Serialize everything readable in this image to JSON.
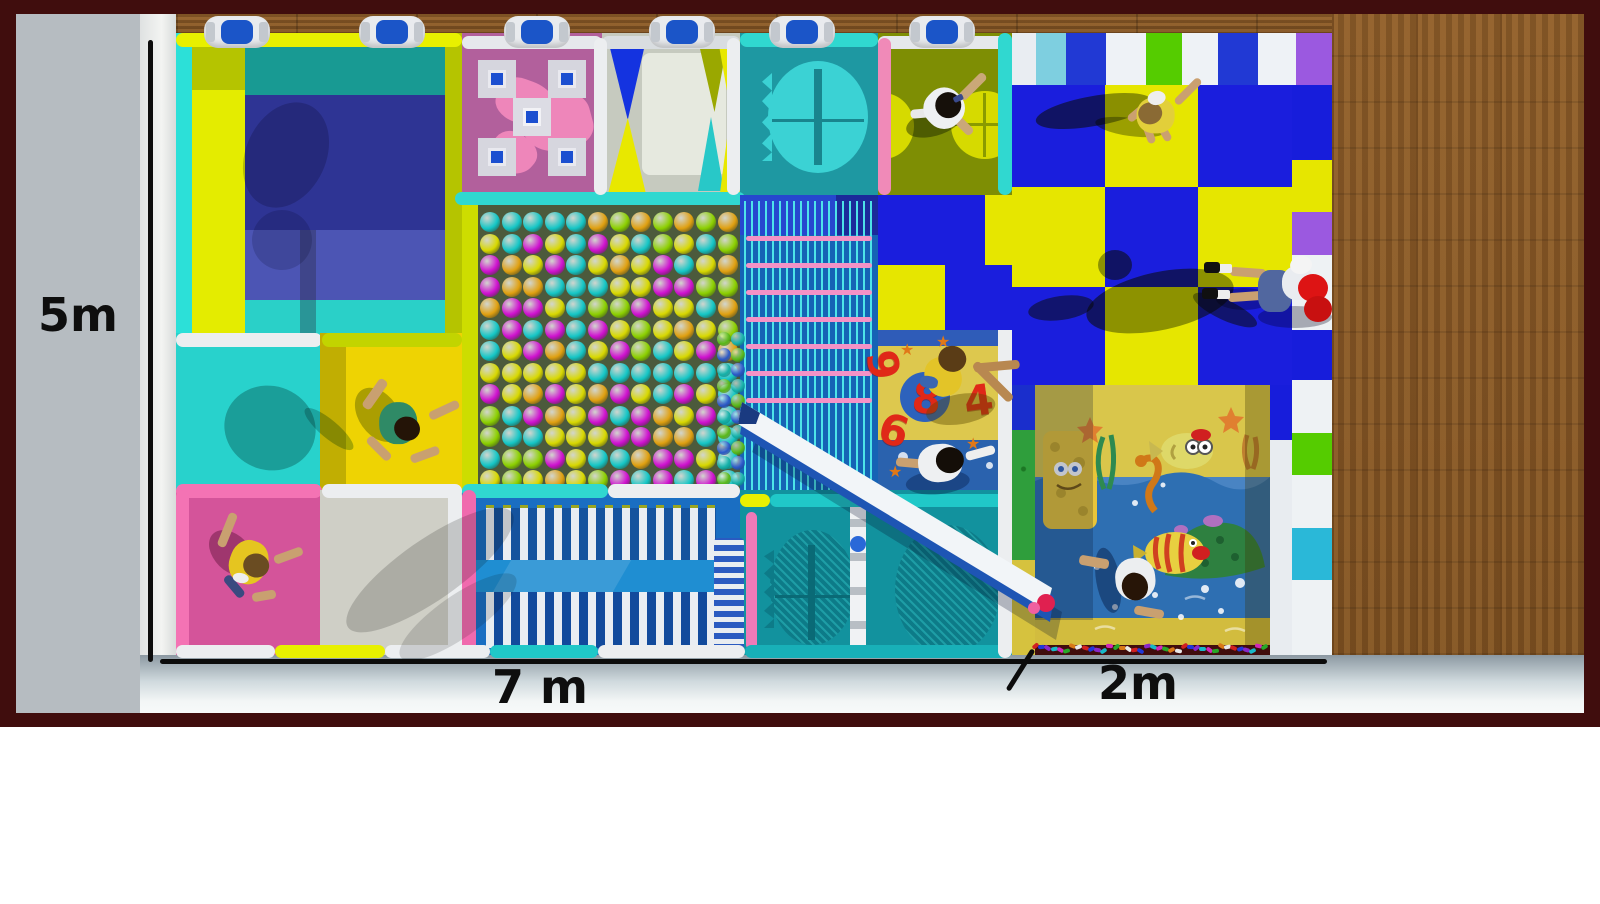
{
  "labels": {
    "height": "5m",
    "width": "7 m",
    "extension": "2m"
  },
  "colors": {
    "frame": "#400d0d",
    "wall": "#b6bcc1",
    "wall_edge": "#f3f4f2",
    "wood": "#8a5a28",
    "floor_top": "#8c99a2",
    "floor_bottom": "#f7f9f9",
    "checker_blue": "#1a1edd",
    "checker_yellow": "#e6e600",
    "ballpit_bg": "#4c5a3c",
    "rope_blue": "#1563b5",
    "rope_pink": "#f492c6",
    "teal": "#12929e",
    "pink_mat": "#d4549a",
    "slide_white": "#f2f5f8",
    "slide_blue": "#1e55b4"
  },
  "clamps": {
    "xs": [
      237,
      392,
      537,
      682,
      802,
      942
    ]
  },
  "top_stripes": [
    {
      "c": "#e9edf2",
      "w": 24
    },
    {
      "c": "#7ecfe0",
      "w": 30
    },
    {
      "c": "#2139d4",
      "w": 40
    },
    {
      "c": "#eef2f6",
      "w": 40
    },
    {
      "c": "#55cc00",
      "w": 36
    },
    {
      "c": "#eef2f6",
      "w": 36
    },
    {
      "c": "#2139d4",
      "w": 40
    },
    {
      "c": "#eef2f6",
      "w": 38
    },
    {
      "c": "#9b59e0",
      "w": 36
    }
  ],
  "right_tiles": [
    {
      "c": "#171ddb",
      "h": 75
    },
    {
      "c": "#e6e600",
      "h": 52
    },
    {
      "c": "#9b59e0",
      "h": 43
    },
    {
      "c": "#eef2f4",
      "h": 75
    },
    {
      "c": "#171ddb",
      "h": 50
    },
    {
      "c": "#eef2f4",
      "h": 53
    },
    {
      "c": "#55cc00",
      "h": 42
    },
    {
      "c": "#eef2f4",
      "h": 53
    },
    {
      "c": "#2ab8d8",
      "h": 52
    },
    {
      "c": "#eef2f4",
      "h": 75
    }
  ],
  "checker": {
    "cols": [
      {
        "x": 1012,
        "w": 93
      },
      {
        "x": 1105,
        "w": 93
      },
      {
        "x": 1198,
        "w": 94
      }
    ],
    "rows": [
      {
        "y": 85,
        "h": 102
      },
      {
        "y": 187,
        "h": 100
      },
      {
        "y": 287,
        "h": 98
      }
    ],
    "pattern": [
      "BYB",
      "YBY",
      "BYB"
    ]
  },
  "checker_inset_cells": [
    {
      "x": 878,
      "y": 195,
      "w": 107,
      "h": 70,
      "k": "B"
    },
    {
      "x": 985,
      "y": 195,
      "w": 27,
      "h": 70,
      "k": "Y"
    },
    {
      "x": 878,
      "y": 265,
      "w": 67,
      "h": 65,
      "k": "Y"
    },
    {
      "x": 945,
      "y": 265,
      "w": 67,
      "h": 65,
      "k": "B"
    }
  ],
  "ball_pit": {
    "palette": [
      "#cf10cf",
      "#d8d800",
      "#14c6c6",
      "#8cd000",
      "#cf10cf",
      "#d8d800",
      "#14c6c6",
      "#e0a010"
    ],
    "cols": 12,
    "rows": 13,
    "x0": 480,
    "y0": 212,
    "dx": 21.6,
    "dy": 21.5,
    "size": 20
  },
  "side_balls": {
    "palette": [
      "#58b818",
      "#14b0a8",
      "#2a58c8"
    ],
    "cols": 2,
    "rows": 10,
    "x0": 717,
    "y0": 332,
    "dx": 14,
    "dy": 15.5,
    "size": 14
  },
  "rope_bars": {
    "count": 7,
    "x": 746,
    "w": 126,
    "y0": 236,
    "dy": 27,
    "c": "#f492c6"
  },
  "number_mat": {
    "numbers": [
      {
        "t": "8",
        "x": 912,
        "y": 378,
        "rot": 6,
        "circle": true
      },
      {
        "t": "4",
        "x": 964,
        "y": 380,
        "rot": -8,
        "circle": false
      },
      {
        "t": "6",
        "x": 879,
        "y": 410,
        "rot": 16,
        "circle": false
      },
      {
        "t": "9",
        "x": 868,
        "y": 344,
        "rot": 80,
        "circle": false
      }
    ],
    "stars": [
      {
        "x": 900,
        "y": 342
      },
      {
        "x": 966,
        "y": 436
      },
      {
        "x": 888,
        "y": 464
      },
      {
        "x": 936,
        "y": 334
      }
    ]
  },
  "confetti": {
    "palette": [
      "#d02020",
      "#2038d8",
      "#8828c8",
      "#18b8c8",
      "#d028b8",
      "#28a828",
      "#d87818",
      "#e8e8e8"
    ],
    "count": 38,
    "x0": 1032,
    "y": 644,
    "dx": 6.2
  },
  "shadows": [
    {
      "x": 1035,
      "y": 96,
      "w": 118,
      "h": 30,
      "rot": -10,
      "c": "rgba(70,80,0,0.55)"
    },
    {
      "x": 1095,
      "y": 118,
      "w": 70,
      "h": 18,
      "rot": 8,
      "c": "rgba(70,80,0,0.45)"
    },
    {
      "x": 1085,
      "y": 272,
      "w": 150,
      "h": 58,
      "rot": -12,
      "c": "rgba(75,85,0,0.55)"
    },
    {
      "x": 1098,
      "y": 250,
      "w": 34,
      "h": 30,
      "rot": 0,
      "c": "rgba(75,85,0,0.55)"
    },
    {
      "x": 1028,
      "y": 296,
      "w": 66,
      "h": 24,
      "rot": -8,
      "c": "rgba(75,85,0,0.5)"
    },
    {
      "x": 1190,
      "y": 300,
      "w": 70,
      "h": 20,
      "rot": 25,
      "c": "rgba(75,85,0,0.5)"
    },
    {
      "x": 1216,
      "y": 288,
      "w": 56,
      "h": 22,
      "rot": 0,
      "c": "rgba(20,25,60,0.35)"
    },
    {
      "x": 224,
      "y": 386,
      "w": 92,
      "h": 84,
      "rot": 18,
      "c": "rgba(0,75,75,0.35)"
    },
    {
      "x": 298,
      "y": 420,
      "w": 62,
      "h": 18,
      "rot": 40,
      "c": "rgba(0,75,75,0.30)"
    },
    {
      "x": 246,
      "y": 100,
      "w": 80,
      "h": 110,
      "rot": 25,
      "c": "rgba(10,10,60,0.22)"
    },
    {
      "x": 252,
      "y": 210,
      "w": 60,
      "h": 60,
      "rot": -15,
      "c": "rgba(10,10,60,0.18)"
    },
    {
      "x": 330,
      "y": 540,
      "w": 200,
      "h": 60,
      "rot": -35,
      "c": "rgba(40,40,40,0.20)"
    },
    {
      "x": 388,
      "y": 596,
      "w": 140,
      "h": 42,
      "rot": -35,
      "c": "rgba(40,40,40,0.16)"
    },
    {
      "x": 556,
      "y": 350,
      "w": 120,
      "h": 44,
      "rot": -30,
      "c": "rgba(255,255,255,0.10)"
    }
  ],
  "people": [
    {
      "id": "kid-basket-zone",
      "x": 945,
      "y": 110,
      "rot": -25,
      "parts": [
        [
          -44,
          -6,
          56,
          26,
          "rgba(20,30,0,0.45)",
          "50%",
          10
        ],
        [
          -6,
          14,
          30,
          9,
          "#caa878",
          "4px",
          70
        ],
        [
          18,
          -14,
          34,
          9,
          "#caa878",
          "4px",
          -20
        ],
        [
          -34,
          -10,
          30,
          9,
          "#e8e8e8",
          "4px",
          20
        ],
        [
          -20,
          -22,
          40,
          40,
          "#eef0f2",
          "45%",
          -20
        ],
        [
          -8,
          -16,
          26,
          26,
          "#16100a",
          "50%",
          0
        ],
        [
          12,
          -8,
          10,
          6,
          "#3a4a8c",
          "2px",
          0
        ]
      ]
    },
    {
      "id": "kid-checkerboard",
      "x": 1152,
      "y": 112,
      "rot": -10,
      "parts": [
        [
          -20,
          14,
          26,
          8,
          "#caa070",
          "4px",
          80
        ],
        [
          -4,
          16,
          24,
          8,
          "#caa070",
          "4px",
          70
        ],
        [
          22,
          -18,
          34,
          8,
          "#caa070",
          "4px",
          -35
        ],
        [
          -26,
          -6,
          24,
          8,
          "#caa070",
          "4px",
          150
        ],
        [
          -16,
          -14,
          38,
          36,
          "#e2cf3a",
          "45%",
          10
        ],
        [
          -14,
          -10,
          24,
          22,
          "#8a6a34",
          "50%",
          0
        ],
        [
          -2,
          -20,
          18,
          14,
          "#eeeeee",
          "50%",
          0
        ]
      ]
    },
    {
      "id": "adult-red-jacket",
      "x": 1288,
      "y": 290,
      "rot": 0,
      "parts": [
        [
          -30,
          16,
          74,
          22,
          "rgba(0,0,30,0.30)",
          "50%",
          0
        ],
        [
          -58,
          -22,
          36,
          9,
          "#c9a070",
          "4px",
          4
        ],
        [
          -60,
          2,
          36,
          9,
          "#c9a070",
          "4px",
          -4
        ],
        [
          -70,
          -26,
          14,
          9,
          "#eeeeee",
          "2px",
          0
        ],
        [
          -72,
          0,
          14,
          9,
          "#eeeeee",
          "2px",
          0
        ],
        [
          -84,
          -28,
          16,
          11,
          "#101010",
          "3px",
          0
        ],
        [
          -86,
          -2,
          16,
          11,
          "#101010",
          "3px",
          0
        ],
        [
          -30,
          -20,
          34,
          42,
          "#51679f",
          "35%",
          0
        ],
        [
          -6,
          -24,
          32,
          34,
          "#e9ecf0",
          "45%",
          0
        ],
        [
          2,
          -34,
          22,
          18,
          "#f4f4f4",
          "50%",
          -10
        ],
        [
          10,
          -16,
          30,
          28,
          "#dd1414",
          "50%",
          0
        ],
        [
          16,
          6,
          28,
          26,
          "#c81010",
          "50%",
          0
        ]
      ]
    },
    {
      "id": "kid-yellow-trampoline",
      "x": 398,
      "y": 420,
      "rot": 15,
      "parts": [
        [
          -50,
          -20,
          60,
          40,
          "rgba(70,80,0,0.40)",
          "50%",
          40
        ],
        [
          -34,
          -36,
          10,
          34,
          "#c9a070",
          "4px",
          20
        ],
        [
          26,
          -26,
          32,
          9,
          "#c9a070",
          "4px",
          -40
        ],
        [
          -26,
          28,
          30,
          9,
          "#c9a070",
          "4px",
          30
        ],
        [
          20,
          22,
          30,
          9,
          "#c9a070",
          "4px",
          -35
        ],
        [
          -18,
          -18,
          38,
          42,
          "#2f8a66",
          "45%",
          -15
        ],
        [
          -2,
          -6,
          26,
          24,
          "#241407",
          "50%",
          0
        ]
      ]
    },
    {
      "id": "kid-pink-trampoline",
      "x": 248,
      "y": 560,
      "rot": 10,
      "parts": [
        [
          -44,
          -22,
          54,
          36,
          "rgba(60,0,30,0.35)",
          "50%",
          35
        ],
        [
          -30,
          -44,
          9,
          36,
          "#c9a070",
          "4px",
          12
        ],
        [
          24,
          -16,
          30,
          9,
          "#c9a070",
          "4px",
          -30
        ],
        [
          -22,
          24,
          26,
          9,
          "#3a4a80",
          "4px",
          40
        ],
        [
          10,
          28,
          24,
          9,
          "#c9a070",
          "4px",
          -20
        ],
        [
          -18,
          -20,
          38,
          44,
          "#e5c520",
          "45%",
          10
        ],
        [
          -4,
          -8,
          26,
          24,
          "#6a4c22",
          "50%",
          0
        ],
        [
          -12,
          14,
          16,
          10,
          "#eeeeee",
          "50%",
          0
        ]
      ]
    },
    {
      "id": "kid-number-mat-top",
      "x": 952,
      "y": 372,
      "rot": 10,
      "parts": [
        [
          -20,
          20,
          70,
          30,
          "rgba(90,70,0,0.40)",
          "50%",
          -20
        ],
        [
          16,
          -2,
          52,
          9,
          "#b88850",
          "4px",
          35
        ],
        [
          20,
          -18,
          46,
          9,
          "#b88850",
          "4px",
          -15
        ],
        [
          -26,
          -14,
          36,
          40,
          "#e3c428",
          "45%",
          -30
        ],
        [
          -16,
          -26,
          28,
          26,
          "#5a3c16",
          "50%",
          0
        ],
        [
          -30,
          8,
          18,
          12,
          "#3a66b0",
          "40%",
          0
        ]
      ]
    },
    {
      "id": "kid-number-mat-bottom",
      "x": 940,
      "y": 462,
      "rot": -5,
      "parts": [
        [
          -36,
          8,
          64,
          24,
          "rgba(0,20,60,0.35)",
          "50%",
          0
        ],
        [
          -44,
          -6,
          30,
          9,
          "#c9a070",
          "4px",
          10
        ],
        [
          26,
          -10,
          30,
          9,
          "#eeeeee",
          "4px",
          -10
        ],
        [
          -22,
          -18,
          44,
          38,
          "#eef0f2",
          "45%",
          0
        ],
        [
          -4,
          -14,
          28,
          26,
          "#140e08",
          "50%",
          0
        ]
      ]
    },
    {
      "id": "kid-sea-mural",
      "x": 1135,
      "y": 578,
      "rot": 70,
      "parts": [
        [
          -40,
          14,
          66,
          24,
          "rgba(0,15,50,0.40)",
          "50%",
          10
        ],
        [
          -34,
          18,
          10,
          30,
          "#c9a070",
          "4px",
          30
        ],
        [
          22,
          -6,
          30,
          9,
          "#c9a070",
          "4px",
          -60
        ],
        [
          -20,
          -20,
          42,
          40,
          "#eceef0",
          "45%",
          15
        ],
        [
          -6,
          -10,
          28,
          26,
          "#271507",
          "50%",
          0
        ]
      ]
    }
  ]
}
